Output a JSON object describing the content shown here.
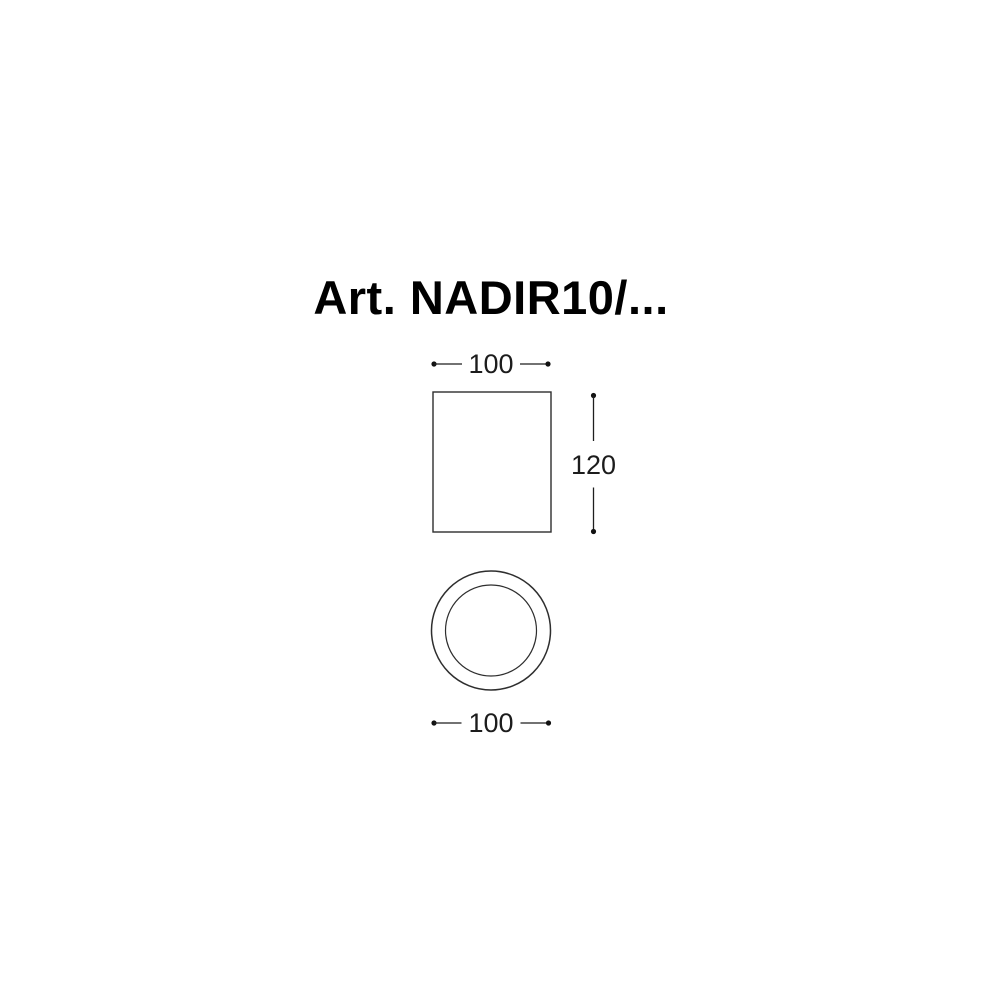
{
  "title": "Art. NADIR10/...",
  "views": {
    "front": {
      "name": "front-view",
      "width_label": "100",
      "height_label": "120"
    },
    "bottom": {
      "name": "bottom-view",
      "diameter_label": "100"
    }
  },
  "colors": {
    "background": "#ffffff",
    "drawing_line": "#2e2e2e",
    "dimension_line": "#1f1f1f",
    "dimension_text": "#1c1c1c",
    "title_text": "#000000"
  }
}
